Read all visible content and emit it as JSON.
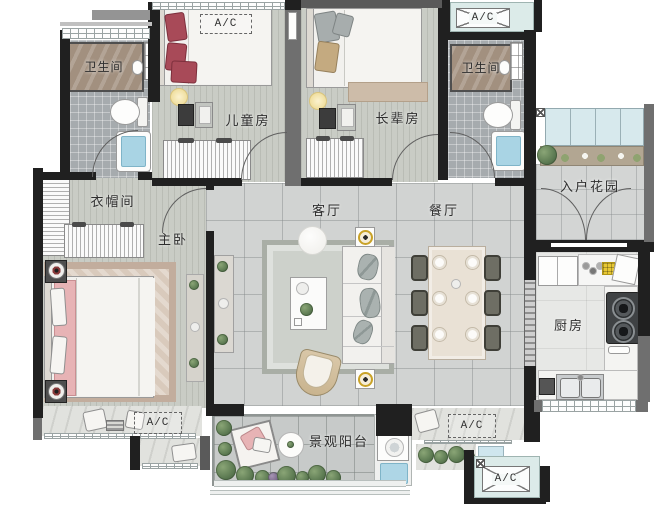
{
  "plan": {
    "rooms": {
      "bathroom_left": "卫生间",
      "bathroom_right": "卫生间",
      "kids_room": "儿童房",
      "elders_room": "长辈房",
      "entry_garden": "入户花园",
      "cloakroom": "衣帽间",
      "master_bedroom": "主卧",
      "living_room": "客厅",
      "dining_room": "餐厅",
      "kitchen": "厨房",
      "balcony": "景观阳台"
    },
    "ac": {
      "top_left": "A/C",
      "top_right": "A/C",
      "bottom_left": "A/C",
      "bottom_center": "A/C",
      "bottom_right": "A/C"
    },
    "colors": {
      "wall": "#202020",
      "wall_gray": "#6f6f6f",
      "plank_floor": "#c9ccc5",
      "tile_floor": "#d1d3d2",
      "bath_tile": "#a6abae",
      "shower_marble": "#a2907f",
      "ac_platform": "#dcebe9",
      "bathtub_water": "#a9d4e4",
      "kids_pillow_red": "#a84a56",
      "master_pink": "#e7b3b5",
      "plant_green": "#5c7a52",
      "rug_tan": "#c2ad9d",
      "gold_accent": "#c9a227"
    }
  }
}
